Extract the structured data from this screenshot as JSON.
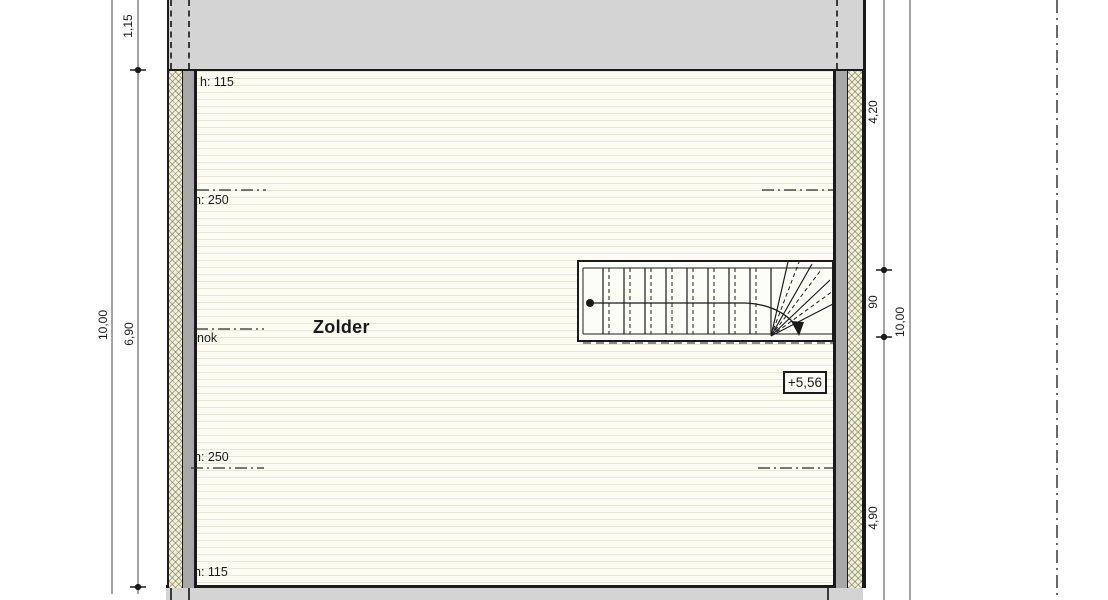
{
  "plan": {
    "room": {
      "name": "Zolder"
    },
    "level_marker": "+5,56",
    "ridge_label": "nok",
    "height_labels": {
      "top": "h: 115",
      "upper": "h: 250",
      "lower": "h: 250",
      "bottom": "h: 115"
    },
    "dimensions": {
      "left": {
        "offset_top": "1,15",
        "total": "10,00",
        "inner": "6,90"
      },
      "right": {
        "upper": "4,20",
        "stair_width": "90",
        "lower": "4,90",
        "total": "10,00"
      }
    },
    "colors": {
      "roof_band": "#d4d4d4",
      "wall_core": "#a8a8a8",
      "insulation_fill": "#f4f1d6",
      "floor_fill": "#fcfcf3",
      "line": "#1a1a1a"
    }
  }
}
